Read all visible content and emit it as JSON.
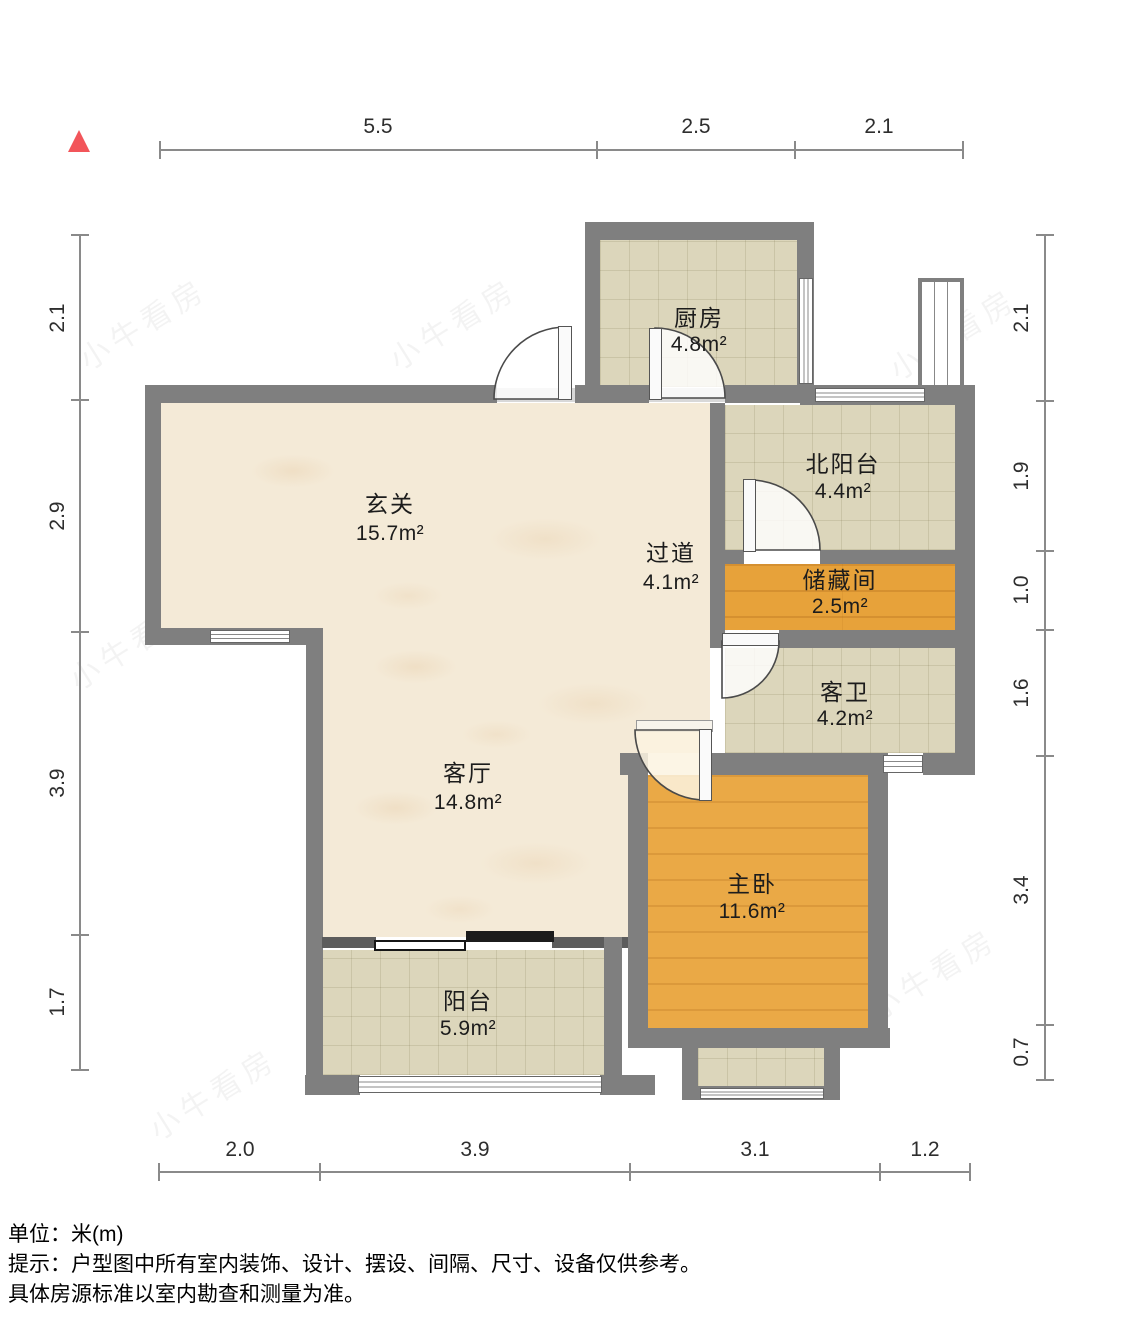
{
  "rooms": [
    {
      "id": "kitchen",
      "name": "厨房",
      "area": "4.8m²"
    },
    {
      "id": "north-balcony",
      "name": "北阳台",
      "area": "4.4m²"
    },
    {
      "id": "entry-hall",
      "name": "玄关",
      "area": "15.7m²"
    },
    {
      "id": "hallway",
      "name": "过道",
      "area": "4.1m²"
    },
    {
      "id": "storage",
      "name": "储藏间",
      "area": "2.5m²"
    },
    {
      "id": "guest-bath",
      "name": "客卫",
      "area": "4.2m²"
    },
    {
      "id": "living-room",
      "name": "客厅",
      "area": "14.8m²"
    },
    {
      "id": "master-bedroom",
      "name": "主卧",
      "area": "11.6m²"
    },
    {
      "id": "balcony",
      "name": "阳台",
      "area": "5.9m²"
    }
  ],
  "dimensions": {
    "top": [
      "5.5",
      "2.5",
      "2.1"
    ],
    "bottom": [
      "2.0",
      "3.9",
      "3.1",
      "1.2"
    ],
    "left": [
      "2.1",
      "2.9",
      "3.9",
      "1.7"
    ],
    "right": [
      "2.1",
      "1.9",
      "1.0",
      "1.6",
      "3.4",
      "0.7"
    ]
  },
  "footer": {
    "line1": "单位：米(m)",
    "line2": "提示：户型图中所有室内装饰、设计、摆设、间隔、尺寸、设备仅供参考。",
    "line3": "具体房源标准以室内勘查和测量为准。"
  },
  "watermark": "小牛看房",
  "colors": {
    "wall": "#7f7f7f",
    "floor_marble": "#f4ead7",
    "floor_tile": "#dcd6bb",
    "floor_wood": "#e7a23a",
    "north_arrow": "#f2555a",
    "dimension_line": "#8a8a8a"
  }
}
